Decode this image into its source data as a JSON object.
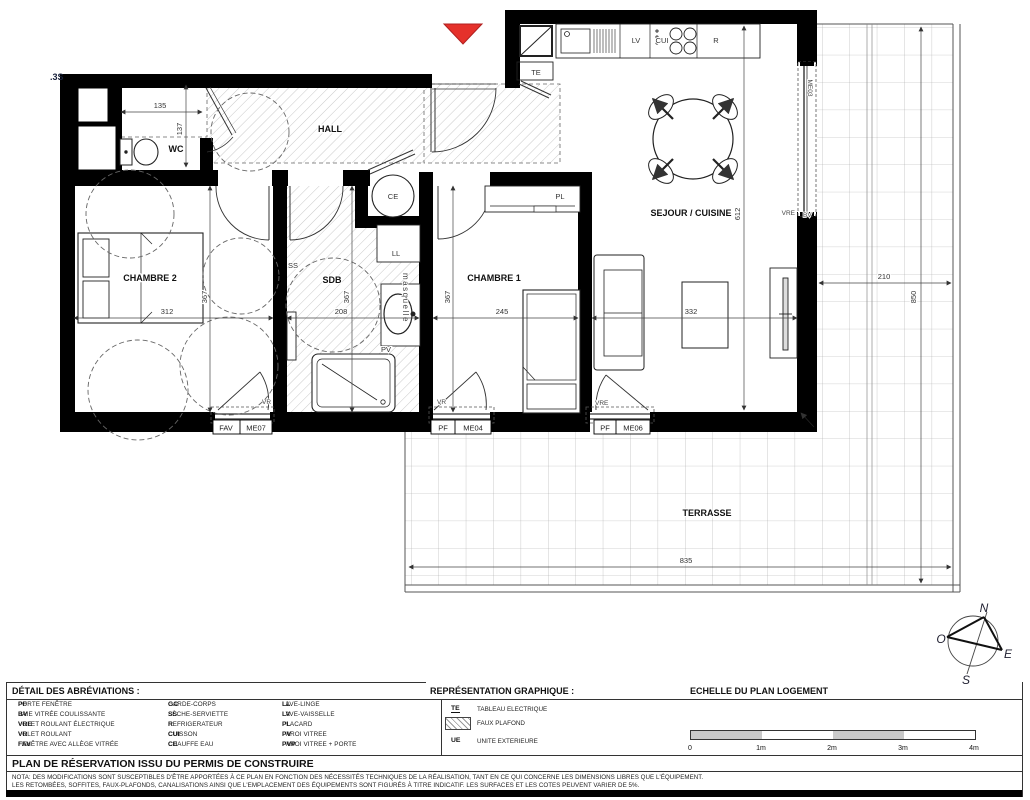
{
  "colors": {
    "wall": "#000000",
    "accent_red": "#e5312b",
    "hatch": "#c9c9c9",
    "grid_line": "#a8a8a8",
    "dim_text": "#333333"
  },
  "plan": {
    "corner_ref": ".3S",
    "rooms": {
      "hall": "HALL",
      "wc": "WC",
      "chambre2": "CHAMBRE 2",
      "sdb": "SDB",
      "chambre1": "CHAMBRE 1",
      "sejour_cuisine": "SEJOUR / CUISINE",
      "terrasse": "TERRASSE"
    },
    "equipment": {
      "ce": "CE",
      "ll": "LL",
      "ss": "SS",
      "pl": "PL",
      "pv": "PV",
      "te": "TE",
      "lv": "LV",
      "cui": "CUI",
      "r": "R",
      "vasque_label": "masquelle"
    },
    "dims": {
      "wc_width": "135",
      "wc_depth": "137",
      "chambre2_width": "312",
      "chambre2_depth": "367",
      "sdb_width": "208",
      "sdb_depth": "367",
      "chambre1_width": "245",
      "chambre1_depth": "367",
      "sejour_width": "332",
      "sejour_depth": "612",
      "terrasse_width": "835",
      "terrasse_side_width": "210",
      "terrasse_side_depth": "850"
    },
    "openings": {
      "me03": {
        "ref": "ME03",
        "left": "VRE",
        "right": "BV"
      },
      "me07": {
        "type": "FAV",
        "ref": "ME07",
        "shutter": "VR"
      },
      "me04": {
        "type": "PF",
        "ref": "ME04",
        "shutter": "VR"
      },
      "me06": {
        "type": "PF",
        "ref": "ME06",
        "shutter": "VRE"
      }
    }
  },
  "compass": {
    "north": "N",
    "west": "O",
    "east": "E",
    "south": "S"
  },
  "footer": {
    "abbr_title": "DÉTAIL DES ABRÉVIATIONS :",
    "graphic_title": "REPRÉSENTATION GRAPHIQUE :",
    "scale_title": "ECHELLE DU PLAN LOGEMENT",
    "abbr_col1": [
      {
        "abbr": "PF",
        "label": "PORTE FENÊTRE"
      },
      {
        "abbr": "BV",
        "label": "BAIE VITRÉE COULISSANTE"
      },
      {
        "abbr": "VRE",
        "label": "VOLET ROULANT ÉLECTRIQUE"
      },
      {
        "abbr": "VR",
        "label": "VOLET ROULANT"
      },
      {
        "abbr": "FAV",
        "label": "FENÊTRE AVEC ALLÈGE VITRÉE"
      }
    ],
    "abbr_col2": [
      {
        "abbr": "GC",
        "label": "GARDE-CORPS"
      },
      {
        "abbr": "SS",
        "label": "SÈCHE-SERVIETTE"
      },
      {
        "abbr": "R",
        "label": "REFRIGERATEUR"
      },
      {
        "abbr": "CUI",
        "label": "CUISSON"
      },
      {
        "abbr": "CE",
        "label": "CHAUFFE EAU"
      }
    ],
    "abbr_col3": [
      {
        "abbr": "LL",
        "label": "LAVE-LINGE"
      },
      {
        "abbr": "LV",
        "label": "LAVE-VAISSELLE"
      },
      {
        "abbr": "PL",
        "label": "PLACARD"
      },
      {
        "abbr": "PV",
        "label": "PAROI VITREE"
      },
      {
        "abbr": "PVP",
        "label": "PAROI VITREE + PORTE"
      }
    ],
    "graphic_items": [
      {
        "abbr": "TE",
        "label": "TABLEAU ELECTRIQUE"
      },
      {
        "abbr": "",
        "label": "FAUX PLAFOND"
      },
      {
        "abbr": "UE",
        "label": "UNITE EXTERIEURE"
      }
    ],
    "scale_ticks": [
      "0",
      "1m",
      "2m",
      "3m",
      "4m"
    ],
    "reservation_title": "PLAN DE RÉSERVATION ISSU DU PERMIS DE CONSTRUIRE",
    "nota_line1": "NOTA: DES MODIFICATIONS SONT SUSCEPTIBLES D'ÊTRE APPORTÉES À CE PLAN EN FONCTION DES NÉCESSITÉS TECHNIQUES DE LA RÉALISATION, TANT EN CE QUI CONCERNE LES DIMENSIONS LIBRES QUE L'ÉQUIPEMENT.",
    "nota_line2": "LES RETOMBÉES, SOFFITES, FAUX-PLAFONDS, CANALISATIONS AINSI QUE L'EMPLACEMENT DES ÉQUIPEMENTS SONT FIGURÉS À TITRE INDICATIF. LES SURFACES ET LES COTES PEUVENT VARIER DE 5%."
  }
}
